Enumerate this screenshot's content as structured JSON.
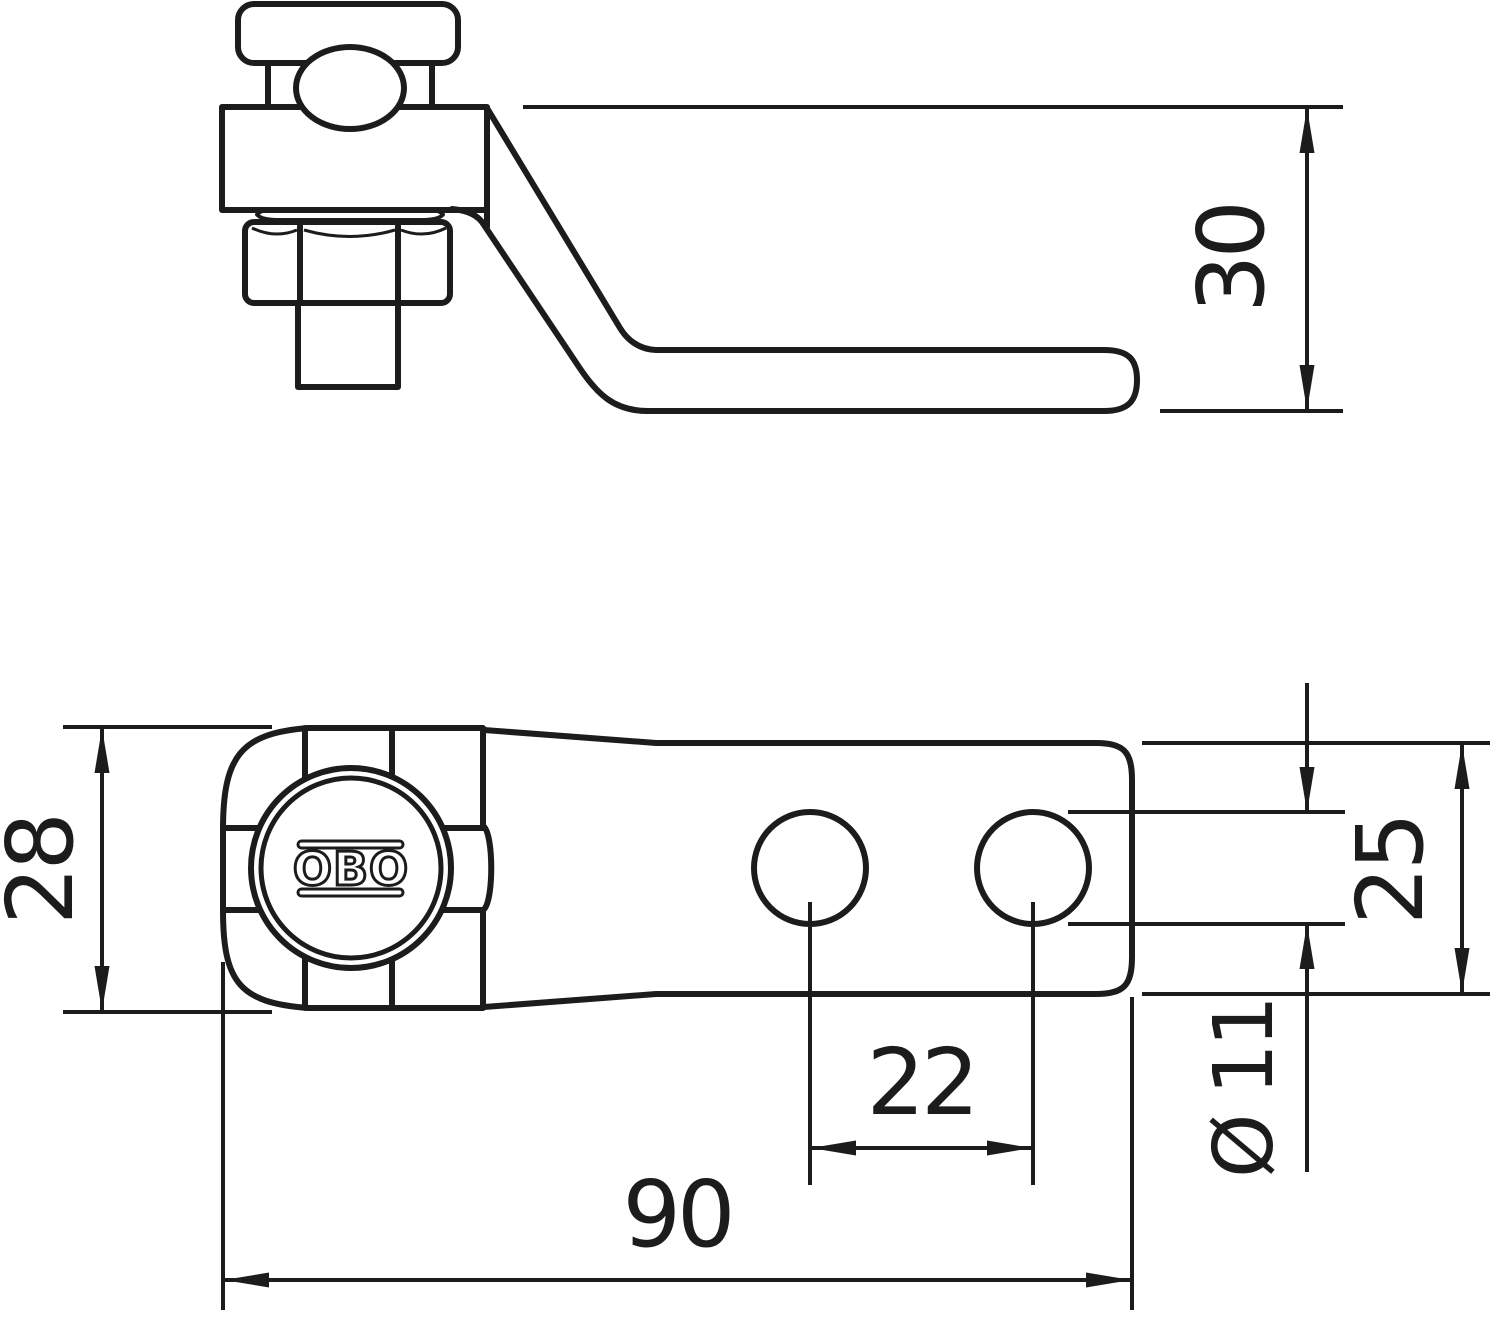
{
  "drawing": {
    "background_color": "#ffffff",
    "line_color": "#1c1c1c",
    "brand_logo": "OBO",
    "views": [
      {
        "name": "side-elevation"
      },
      {
        "name": "plan-view"
      }
    ],
    "dimensions": {
      "bracket_height": {
        "label": "30",
        "orientation": "vertical"
      },
      "head_width": {
        "label": "28",
        "orientation": "vertical"
      },
      "plate_width": {
        "label": "25",
        "orientation": "vertical"
      },
      "hole_spacing": {
        "label": "22",
        "orientation": "horizontal"
      },
      "hole_diameter": {
        "label": "Ø 11",
        "orientation": "vertical"
      },
      "overall_length": {
        "label": "90",
        "orientation": "horizontal"
      }
    }
  }
}
